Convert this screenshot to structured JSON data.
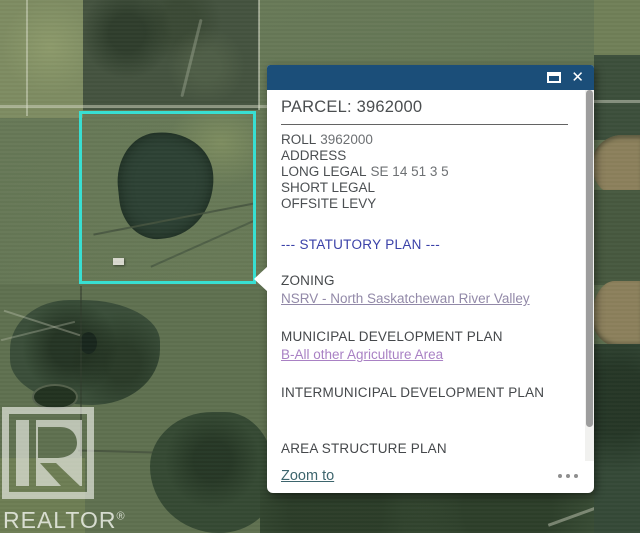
{
  "map": {
    "parcel_outline_color": "#38dfd2",
    "features": [
      "aerial-farmland",
      "forest-patches",
      "river-top-right",
      "field-grid-roads"
    ]
  },
  "watermark": {
    "brand": "REALTOR",
    "registered_mark": "®",
    "logo_icon": "realtor-block-r-icon"
  },
  "popup": {
    "title": "PARCEL: 3962000",
    "header": {
      "maximize_icon": "maximize-window-icon",
      "close_icon": "close-icon",
      "close_glyph": "✕",
      "bg_color": "#1b4e79"
    },
    "fields": [
      {
        "label": "ROLL",
        "value": "3962000"
      },
      {
        "label": "ADDRESS",
        "value": ""
      },
      {
        "label": "LONG LEGAL",
        "value": "SE 14 51 3 5"
      },
      {
        "label": "SHORT LEGAL",
        "value": ""
      },
      {
        "label": "OFFSITE LEVY",
        "value": ""
      }
    ],
    "statutory_divider": "--- STATUTORY PLAN ---",
    "statutory_color": "#3a41a8",
    "sections": [
      {
        "heading": "ZONING",
        "link": "NSRV - North Saskatchewan River Valley",
        "link_color": "#9289a8"
      },
      {
        "heading": "MUNICIPAL DEVELOPMENT PLAN",
        "link": "B-All other Agriculture Area",
        "link_color": "#a981c4"
      },
      {
        "heading": "INTERMUNICIPAL DEVELOPMENT PLAN",
        "link": "",
        "link_color": ""
      },
      {
        "heading": "AREA STRUCTURE PLAN",
        "link": "Genesee ASP",
        "link_color": "#a981c4"
      }
    ],
    "footer": {
      "zoom_to_label": "Zoom to",
      "zoom_to_color": "#3d656d",
      "more_options_icon": "ellipsis-icon"
    }
  }
}
